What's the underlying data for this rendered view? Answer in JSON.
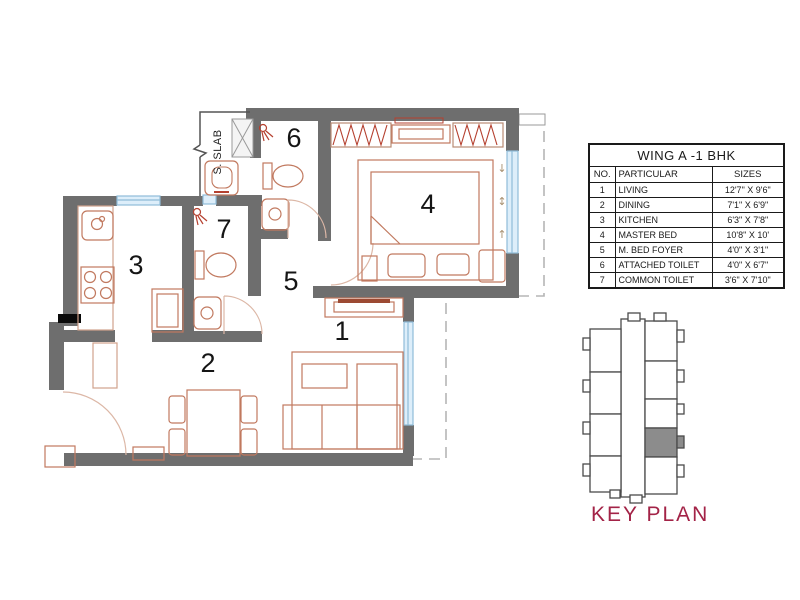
{
  "floor_plan": {
    "room_numbers": {
      "living": "1",
      "dining": "2",
      "kitchen": "3",
      "master_bed": "4",
      "m_bed_foyer": "5",
      "attached_toilet": "6",
      "common_toilet": "7"
    },
    "slab_label": "S. SLAB",
    "window_arrows": {
      "down": "↓",
      "updown": "↕",
      "up": "↑"
    }
  },
  "table": {
    "title": "WING A -1 BHK",
    "headers": [
      "NO.",
      "PARTICULAR",
      "SIZES"
    ],
    "rows": [
      [
        "1",
        "LIVING",
        "12'7\" X 9'6\""
      ],
      [
        "2",
        "DINING",
        "7'1\" X 6'9\""
      ],
      [
        "3",
        "KITCHEN",
        "6'3\" X 7'8\""
      ],
      [
        "4",
        "MASTER BED",
        "10'8\" X 10'"
      ],
      [
        "5",
        "M. BED FOYER",
        "4'0\" X 3'1\""
      ],
      [
        "6",
        "ATTACHED TOILET",
        "4'0\" X 6'7\""
      ],
      [
        "7",
        "COMMON TOILET",
        "3'6\" X 7'10\""
      ]
    ]
  },
  "key_plan": {
    "caption": "KEY PLAN"
  },
  "colors": {
    "wall": "#6e6e6e",
    "furniture_line": "#c1795f",
    "accent_red": "#b5402f",
    "window_blue": "#9cc4dd",
    "window_fill": "#ddeefa",
    "dashed_boundary": "#b5b5b5",
    "keyplan_outline": "#4a4a4a",
    "keyplan_highlight": "#8c8c8c",
    "caption_red": "#a32347",
    "text": "#1a1a1a"
  }
}
